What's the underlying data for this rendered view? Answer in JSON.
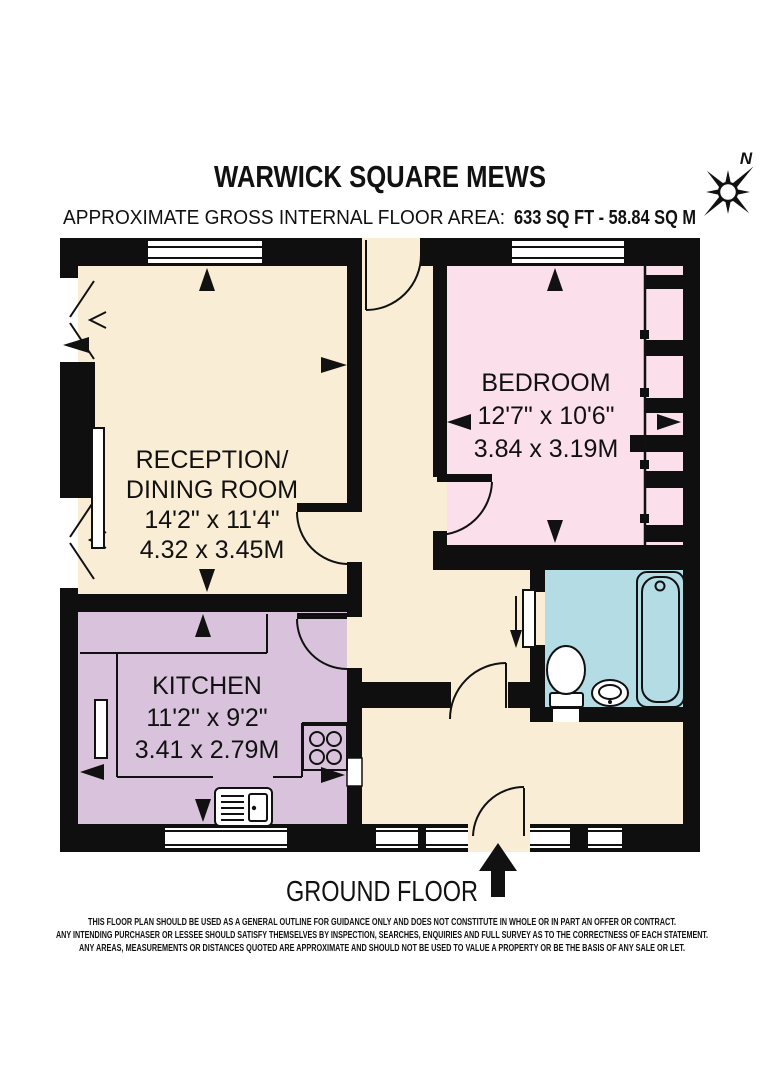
{
  "header": {
    "title": "WARWICK SQUARE MEWS",
    "area_label": "APPROXIMATE GROSS INTERNAL FLOOR AREA:",
    "area_value": "633 SQ FT - 58.84 SQ M",
    "compass_north": "N"
  },
  "rooms": {
    "reception": {
      "name_line1": "RECEPTION/",
      "name_line2": "DINING ROOM",
      "dims_imperial": "14'2\" x 11'4\"",
      "dims_metric": "4.32 x 3.45M",
      "color": "#FAEDD5"
    },
    "bedroom": {
      "name": "BEDROOM",
      "dims_imperial": "12'7\" x 10'6\"",
      "dims_metric": "3.84 x 3.19M",
      "color": "#FBDFEA"
    },
    "kitchen": {
      "name": "KITCHEN",
      "dims_imperial": "11'2\" x 9'2\"",
      "dims_metric": "3.41 x 2.79M",
      "color": "#D9C3DC"
    },
    "bathroom": {
      "color": "#B4DCE5"
    }
  },
  "plan": {
    "wall_color": "#0f0f0f",
    "hall_color": "#FAEDD5"
  },
  "floor_label": "GROUND FLOOR",
  "disclaimer": {
    "line1": "THIS FLOOR PLAN SHOULD BE USED AS A GENERAL OUTLINE FOR GUIDANCE ONLY AND DOES NOT CONSTITUTE IN WHOLE OR IN PART AN OFFER OR CONTRACT.",
    "line2": "ANY INTENDING PURCHASER OR LESSEE SHOULD SATISFY THEMSELVES BY INSPECTION, SEARCHES, ENQUIRIES AND FULL SURVEY AS TO THE CORRECTNESS OF EACH STATEMENT.",
    "line3": "ANY AREAS, MEASUREMENTS OR DISTANCES QUOTED ARE APPROXIMATE AND SHOULD NOT BE USED TO VALUE A PROPERTY OR BE THE BASIS OF ANY SALE OR LET."
  }
}
